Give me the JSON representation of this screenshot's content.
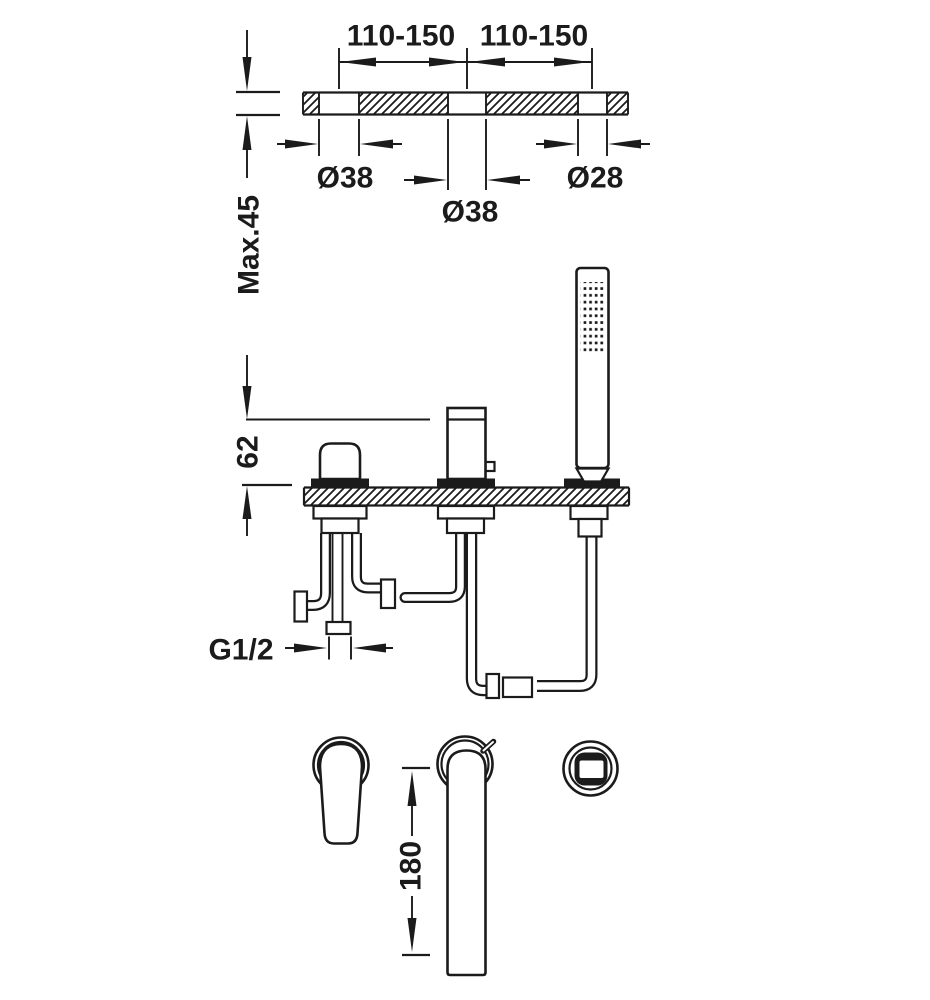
{
  "diagram": {
    "type": "technical installation drawing",
    "subject": "3-hole deck-mounted bath mixer with handshower - installation dimensions",
    "background_color": "#ffffff",
    "line_color": "#1b1b1b",
    "dimensions": {
      "hole_spacing_left": "110-150",
      "hole_spacing_right": "110-150",
      "hole_diameter_left": "Ø38",
      "hole_diameter_center": "Ø38",
      "hole_diameter_right": "Ø28",
      "max_deck_thickness": "Max.45",
      "spout_height_above_deck": "62",
      "connection_thread": "G1/2",
      "spout_reach": "180"
    }
  }
}
